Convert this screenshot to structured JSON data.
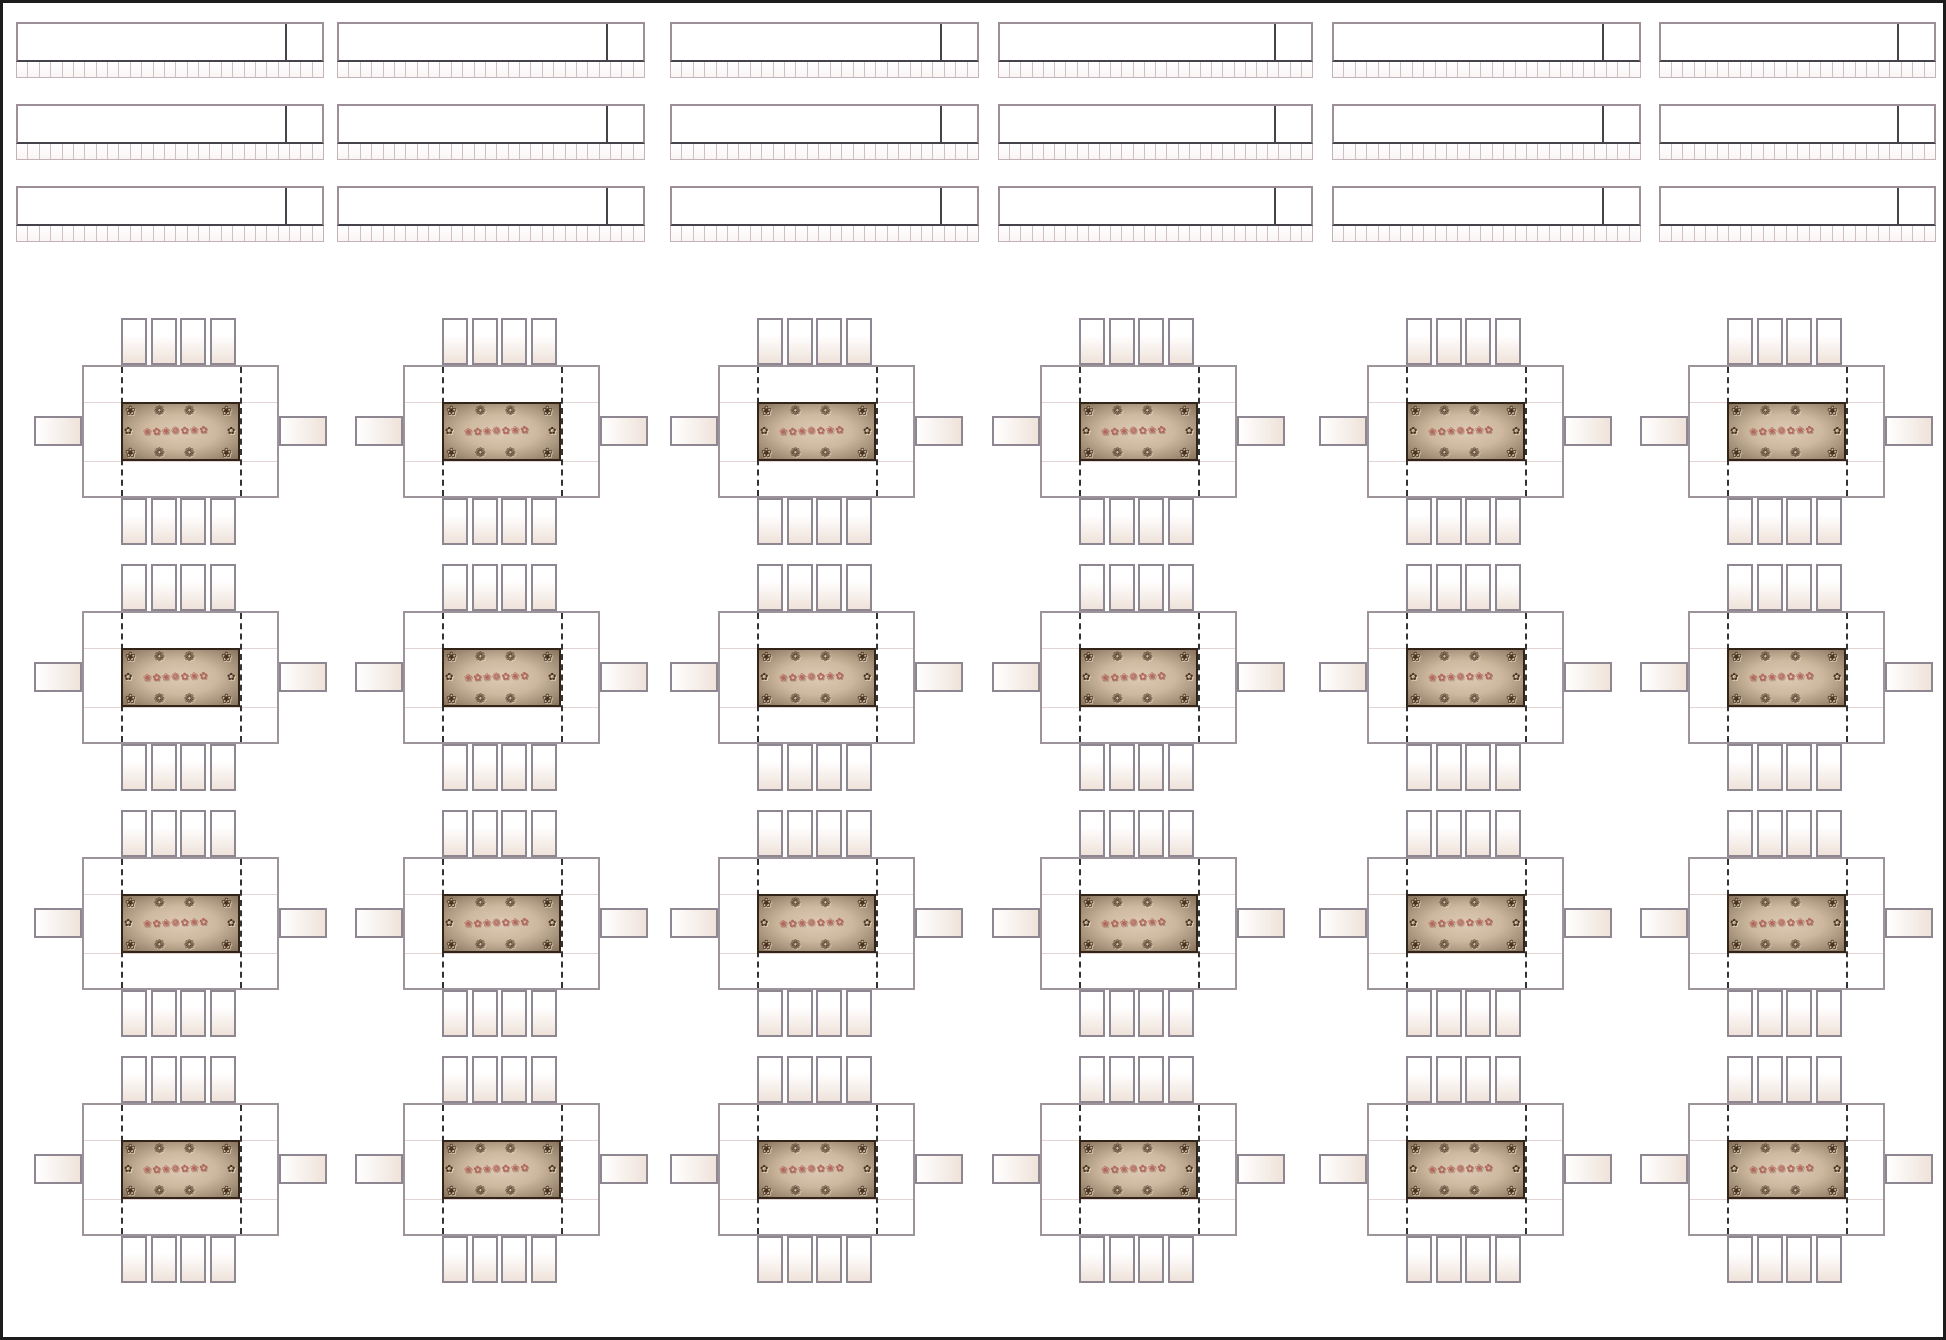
{
  "page": {
    "kind": "banquet-hall-seating-floor-plan",
    "background": "#ffffff",
    "frame_color": "#1c1c1c"
  },
  "head_tables": {
    "rows": 3,
    "columns": 6,
    "count": 18,
    "seats_per_table": 27,
    "surface_fill": "#ffffff",
    "border_color": "#9c8f97",
    "end_divider_color": "#47434a",
    "seat_strip_border": "#c3b2ba",
    "seat_divider_color": "#cfc0c6"
  },
  "guest_tables": {
    "rows": 4,
    "columns": 6,
    "count": 24,
    "chairs_top": 4,
    "chairs_bottom": 4,
    "chairs_left": 1,
    "chairs_right": 1,
    "seats_per_table": 10,
    "table_fill": "#ffffff",
    "table_border": "#9c939b",
    "chair_border": "#8e8791",
    "chair_fill_light": "#ffffff",
    "chair_fill_shade": "#efe3da",
    "fold_dash_color": "#333333",
    "fold_line_color": "#e3d3d3",
    "centerpiece": {
      "fill_center": "#decbb6",
      "fill_edge": "#87735c",
      "border_color": "#33241a",
      "ornament_color": "#4a3320",
      "garland_color": "#b5655b",
      "corner_glyph": "❀",
      "edge_glyph": "✿",
      "cluster_glyph": "❁",
      "garland_text": "❀✿❀❁✿❀✿"
    }
  }
}
